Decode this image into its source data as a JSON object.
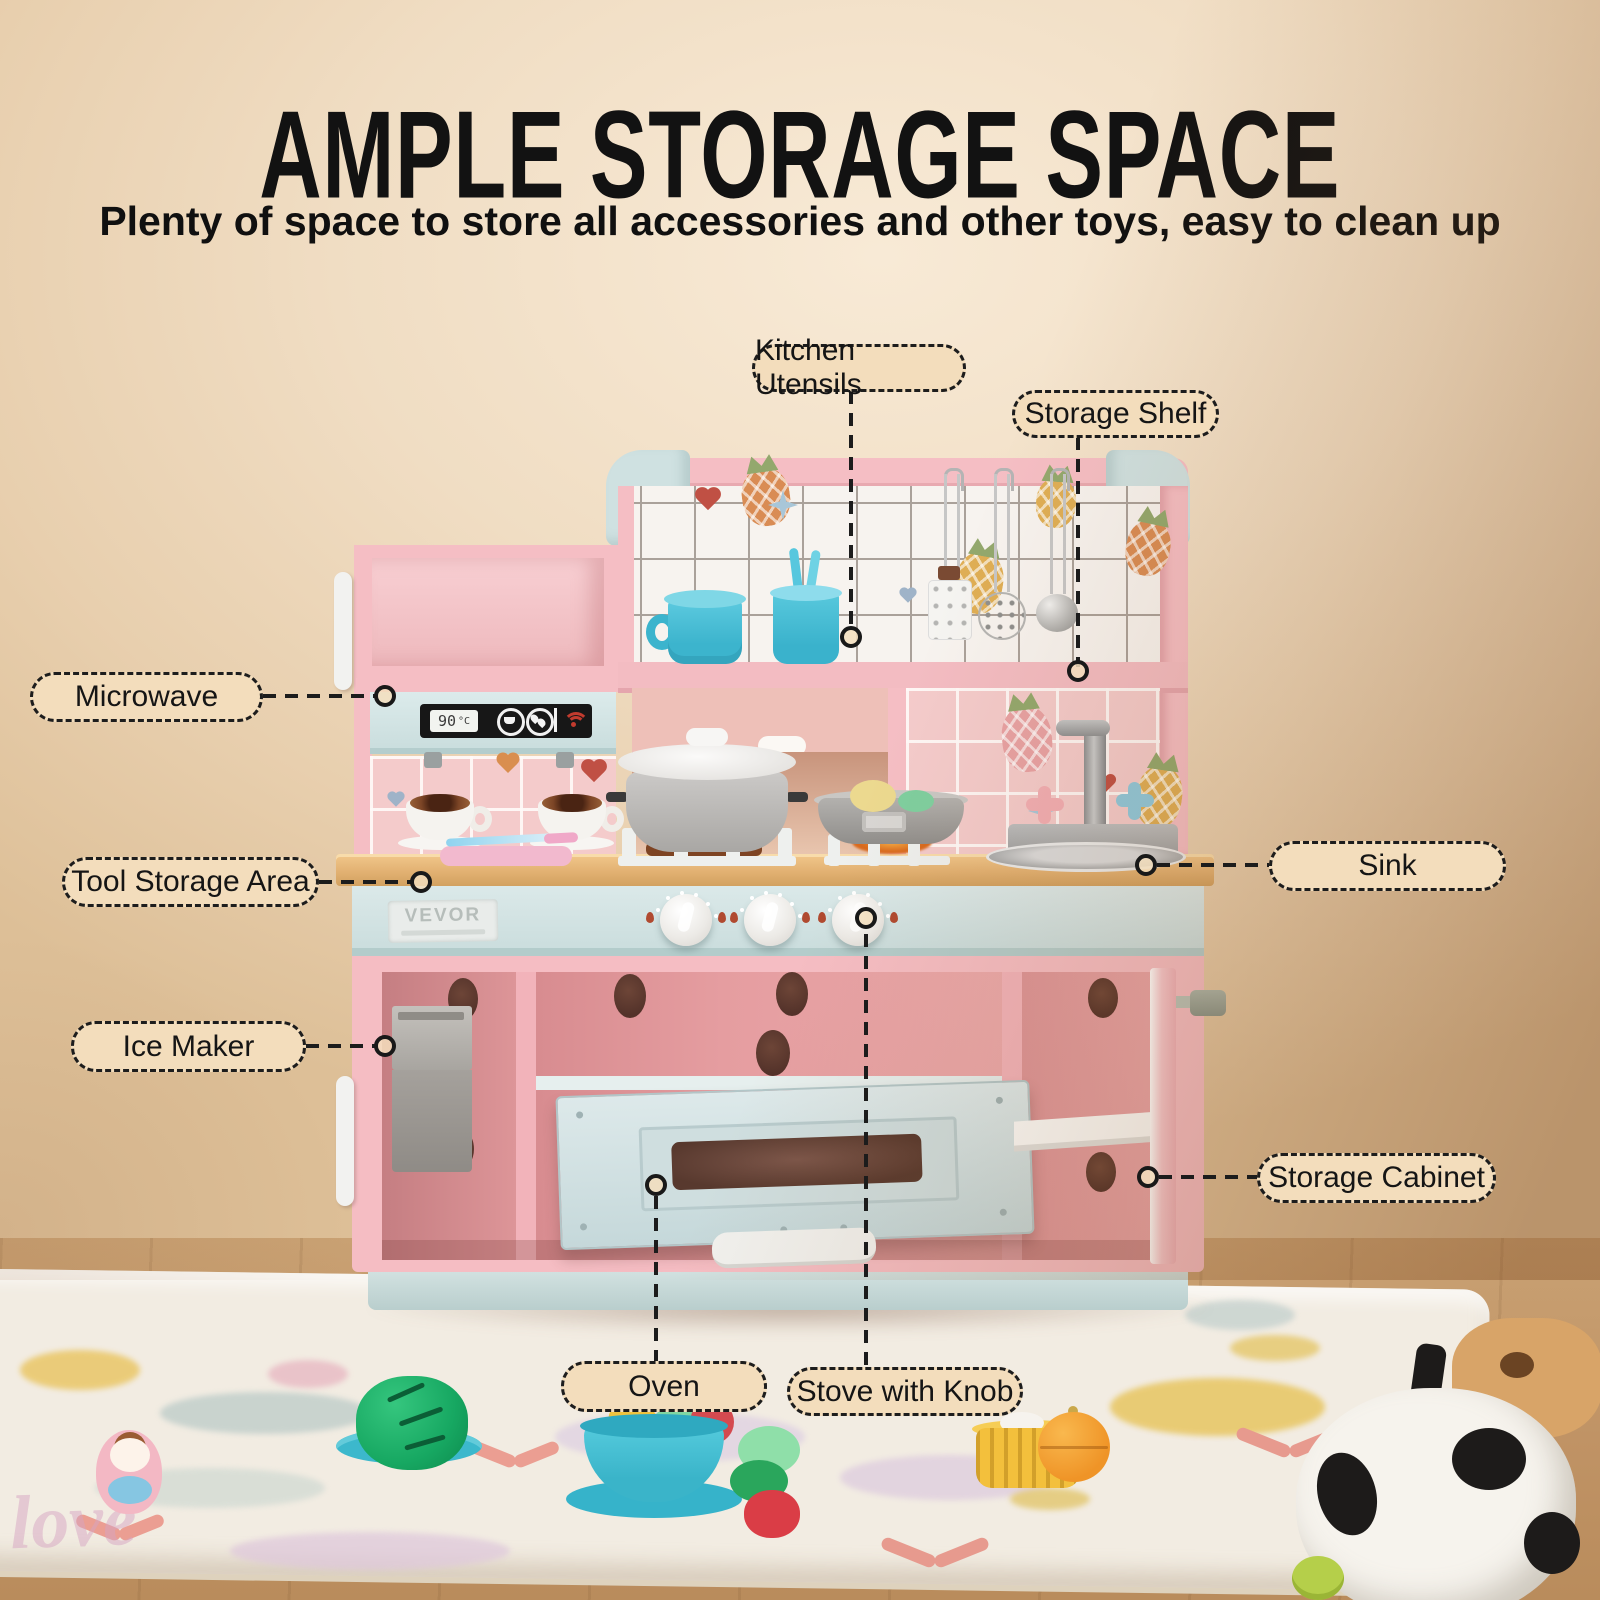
{
  "header": {
    "title": "AMPLE STORAGE SPACE",
    "subtitle": "Plenty of space to store all accessories and other toys, easy to clean up"
  },
  "callouts": {
    "kitchen_utensils": "Kitchen Utensils",
    "storage_shelf": "Storage Shelf",
    "microwave": "Microwave",
    "tool_storage_area": "Tool Storage Area",
    "sink": "Sink",
    "ice_maker": "Ice Maker",
    "storage_cabinet": "Storage Cabinet",
    "oven": "Oven",
    "stove_with_knob": "Stove with Knob"
  },
  "kitchen": {
    "brand": "VEVOR",
    "microwave_display_temp": "90",
    "microwave_display_unit": "°C"
  },
  "rug": {
    "decorative_text": "love"
  },
  "colors": {
    "wall": "#eed9bd",
    "label_bg": "#f3ddbc",
    "kitchen_pink": "#f5bec4",
    "kitchen_mint": "#d4e4e4",
    "countertop_wood": "#e3b277",
    "cabinet_interior": "#df9599",
    "rug": "#f2ece2",
    "floor_wood": "#c9a173",
    "accent_red": "#c23b2e"
  }
}
